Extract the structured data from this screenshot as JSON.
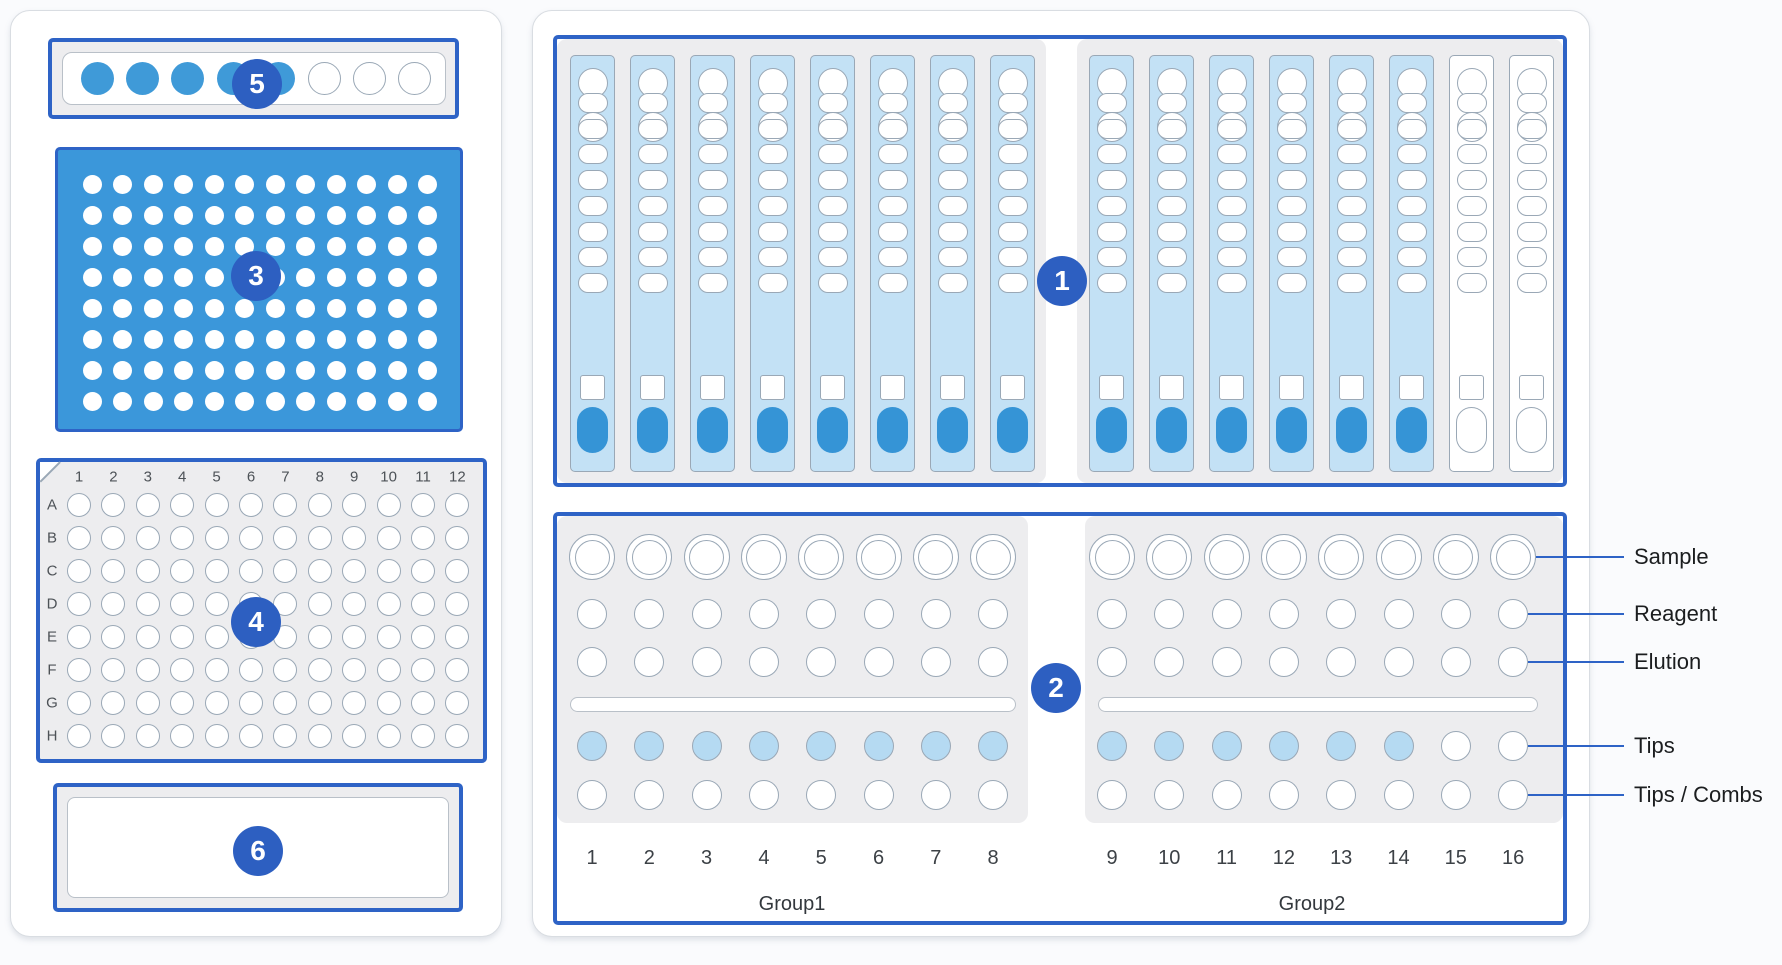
{
  "colors": {
    "accent": "#2e63c6",
    "badge_bg": "#2d5fc1",
    "plate_fill": "#3b97da",
    "strip_fill": "#c3e1f5",
    "tip_fill": "#b5daf2",
    "pill_fill": "#3594d6",
    "filled_slot_fill": "#3f9ad8",
    "well_stroke": "#9aa8b6",
    "inner_stroke": "#b9c0c8",
    "panel_bg": "#ededef"
  },
  "badges": {
    "cartridge_deck": "1",
    "reagent_deck": "2",
    "filled_plate": "3",
    "well_plate": "4",
    "tip_strip": "5",
    "tray": "6"
  },
  "left_panel": {
    "tip_strip": {
      "slots": [
        true,
        true,
        true,
        true,
        true,
        false,
        false,
        false
      ]
    },
    "filled_plate": {
      "rows": 8,
      "cols": 12
    },
    "well_plate": {
      "col_labels": [
        "1",
        "2",
        "3",
        "4",
        "5",
        "6",
        "7",
        "8",
        "9",
        "10",
        "11",
        "12"
      ],
      "row_labels": [
        "A",
        "B",
        "C",
        "D",
        "E",
        "F",
        "G",
        "H"
      ]
    },
    "tray": {}
  },
  "right_panel": {
    "cartridge_deck": {
      "groups": [
        {
          "strips": [
            true,
            true,
            true,
            true,
            true,
            true,
            true,
            true
          ]
        },
        {
          "strips": [
            true,
            true,
            true,
            true,
            true,
            true,
            false,
            false
          ]
        }
      ],
      "wells_per_strip": {
        "circles": 2,
        "ovals": 8,
        "squares": 1,
        "pills": 1
      }
    },
    "reagent_deck": {
      "groups": [
        {
          "label": "Group1",
          "columns": [
            "1",
            "2",
            "3",
            "4",
            "5",
            "6",
            "7",
            "8"
          ],
          "tips": [
            true,
            true,
            true,
            true,
            true,
            true,
            true,
            true
          ]
        },
        {
          "label": "Group2",
          "columns": [
            "9",
            "10",
            "11",
            "12",
            "13",
            "14",
            "15",
            "16"
          ],
          "tips": [
            true,
            true,
            true,
            true,
            true,
            true,
            false,
            false
          ]
        }
      ]
    }
  },
  "legend": {
    "items": [
      "Sample",
      "Reagent",
      "Elution",
      "Tips",
      "Tips / Combs"
    ]
  }
}
